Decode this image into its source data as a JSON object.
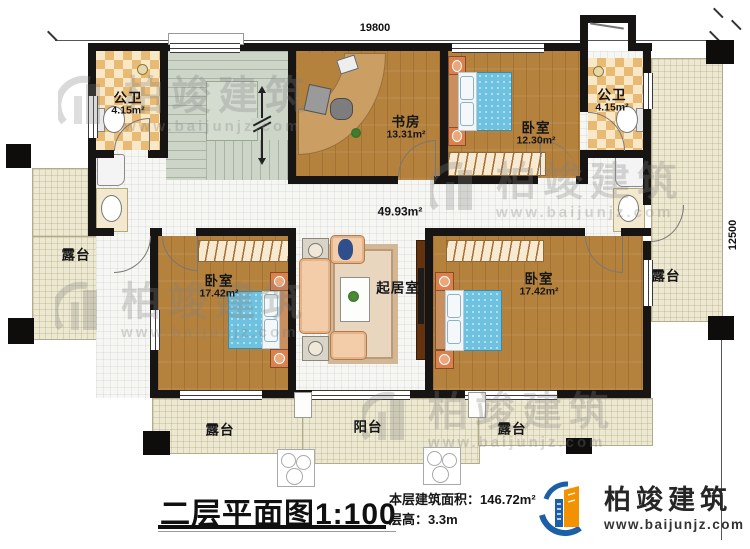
{
  "dimensions": {
    "top": "19800",
    "right": "12500"
  },
  "rooms": [
    {
      "id": "bath-left",
      "label": "公卫",
      "area": "4.15m²"
    },
    {
      "id": "study",
      "label": "书房",
      "area": "13.31m²"
    },
    {
      "id": "bedroom-top",
      "label": "卧室",
      "area": "12.30m²"
    },
    {
      "id": "bath-right",
      "label": "公卫",
      "area": "4.15m²"
    },
    {
      "id": "hall-living",
      "label": "起居室",
      "area": "49.93m²"
    },
    {
      "id": "bedroom-left",
      "label": "卧室",
      "area": "17.42m²"
    },
    {
      "id": "bedroom-right",
      "label": "卧室",
      "area": "17.42m²"
    },
    {
      "id": "terrace-left",
      "label": "露台"
    },
    {
      "id": "terrace-right",
      "label": "露台"
    },
    {
      "id": "terrace-bottom-left",
      "label": "露台"
    },
    {
      "id": "balcony",
      "label": "阳台"
    },
    {
      "id": "terrace-bottom-right",
      "label": "露台"
    }
  ],
  "title_block": {
    "title": "二层平面图",
    "scale": "1:100",
    "area_label": "本层建筑面积：",
    "area_value": "146.72m²",
    "floor_height_label": "层高：",
    "floor_height_value": "3.3m"
  },
  "brand": {
    "name": "柏竣建筑",
    "website": "www.baijunjz.com"
  },
  "watermark": {
    "name": "柏竣建筑",
    "website": "www.baijunjz.com"
  },
  "colors": {
    "wall": "#171513",
    "wood_floor": "#b5823e",
    "tile": "#f6f6f3",
    "terrace": "#ece8d2",
    "stairs": "#ccd5c8",
    "bath_checker": "#e9ba74",
    "bed": "#6ec2e0",
    "brand_blue": "#1a5fa8",
    "brand_orange": "#f39200"
  }
}
